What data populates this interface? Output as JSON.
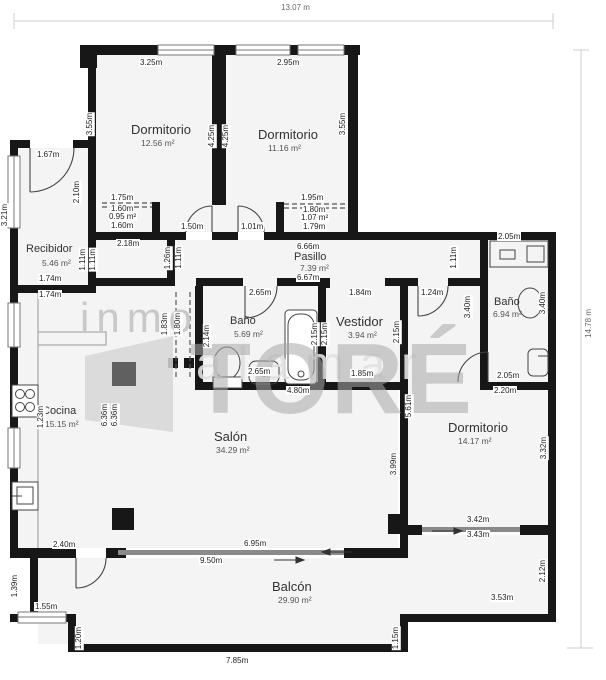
{
  "overall": {
    "width_label": "13.07 m",
    "height_label": "14.78 m"
  },
  "watermark": {
    "line1": "inmo",
    "band": "alamar",
    "brand": "TORÉ"
  },
  "rooms": {
    "dorm1": {
      "name": "Dormitorio",
      "area": "12.56 m²",
      "top": "3.25m",
      "left": "3.55m",
      "right_a": "4.25m",
      "right_b": "4.25m",
      "bottom": "2.18m",
      "door": "1.50m",
      "closet": {
        "top": "1.75m",
        "mid": "1.60m",
        "area": "0.95 m²",
        "bottom": "1.60m"
      }
    },
    "dorm2": {
      "name": "Dormitorio",
      "area": "11.16 m²",
      "top": "2.95m",
      "right": "3.55m",
      "door": "1.01m",
      "closet": {
        "top": "1.95m",
        "mid": "1.80m",
        "area": "1.07 m²",
        "bottom": "1.79m"
      }
    },
    "recibidor": {
      "name": "Recibidor",
      "area": "5.46 m²",
      "door": "1.67m",
      "left": "3.21m",
      "right": "2.10m",
      "bottom_a": "1.74m",
      "bottom_b": "1.74m"
    },
    "pasillo": {
      "name": "Pasillo",
      "area": "7.39 m²",
      "top": "6.66m",
      "bottom": "6.67m",
      "stub_a": "1.11m",
      "stub_b": "1.11m",
      "stub_c": "1.26m",
      "stub_d": "1.11m"
    },
    "bano1": {
      "name": "Baño",
      "area": "5.69 m²",
      "top": "2.65m",
      "left": "2.14m",
      "right_a": "2.15m",
      "right_b": "2.15m",
      "bottom": "2.65m"
    },
    "vestidor": {
      "name": "Vestidor",
      "area": "3.94 m²",
      "top": "1.84m",
      "right": "2.15m",
      "bottom": "1.85m"
    },
    "bano2": {
      "name": "Baño",
      "area": "6.94 m²",
      "nook_top": "2.05m",
      "left": "3.40m",
      "right": "3.40m",
      "bottom": "2.05m",
      "door": "1.24m",
      "stub": "1.11m"
    },
    "cocina": {
      "name": "Cocina",
      "area": "15.15 m²",
      "top": "1.74m",
      "left": "1.23m",
      "mid_a": "6.36m",
      "mid_b": "6.36m",
      "nook_a": "1.83m",
      "nook_b": "1.80m",
      "bottom": "2.40m"
    },
    "salon": {
      "name": "Salón",
      "area": "34.29 m²",
      "top": "4.80m",
      "right": "3.99m",
      "bottom": "6.95m"
    },
    "dorm3": {
      "name": "Dormitorio",
      "area": "14.17 m²",
      "top": "2.20m",
      "left": "5.61m",
      "right": "3.32m",
      "door_a": "3.42m",
      "door_b": "3.43m"
    },
    "balcon": {
      "name": "Balcón",
      "area": "29.90 m²",
      "top": "9.50m",
      "left": "1.39m",
      "step_w": "1.55m",
      "step_h": "1.20m",
      "bottom": "7.85m",
      "right_bottom": "3.53m",
      "right": "2.12m",
      "step_r": "1.15m"
    }
  }
}
